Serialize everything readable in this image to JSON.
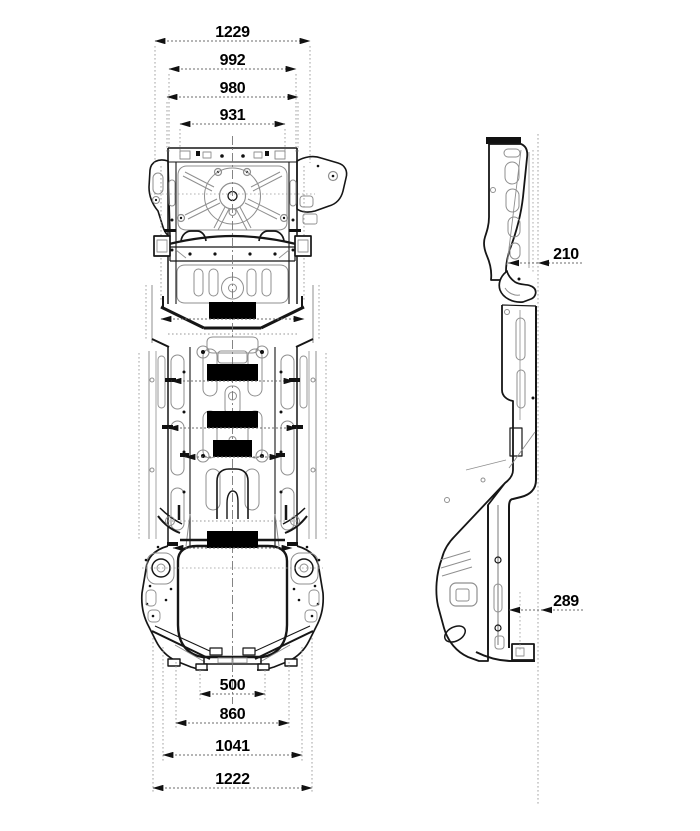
{
  "diagram": {
    "colors": {
      "background": "#ffffff",
      "outline": "#161616",
      "detail_line": "#8f8f8f",
      "dimension_line": "#6b6b6b",
      "extension_line": "#9a9a9a",
      "label_text": "#000000"
    },
    "dimensions": {
      "top": [
        {
          "label": "1229"
        },
        {
          "label": "992"
        },
        {
          "label": "980"
        },
        {
          "label": "931"
        }
      ],
      "inner": [
        {
          "label": "1200"
        },
        {
          "label": "1065"
        },
        {
          "label": "1076"
        },
        {
          "label": "834"
        },
        {
          "label": "1013"
        }
      ],
      "bottom": [
        {
          "label": "500"
        },
        {
          "label": "860"
        },
        {
          "label": "1041"
        },
        {
          "label": "1222"
        }
      ],
      "side": [
        {
          "label": "210"
        },
        {
          "label": "289"
        }
      ]
    }
  }
}
